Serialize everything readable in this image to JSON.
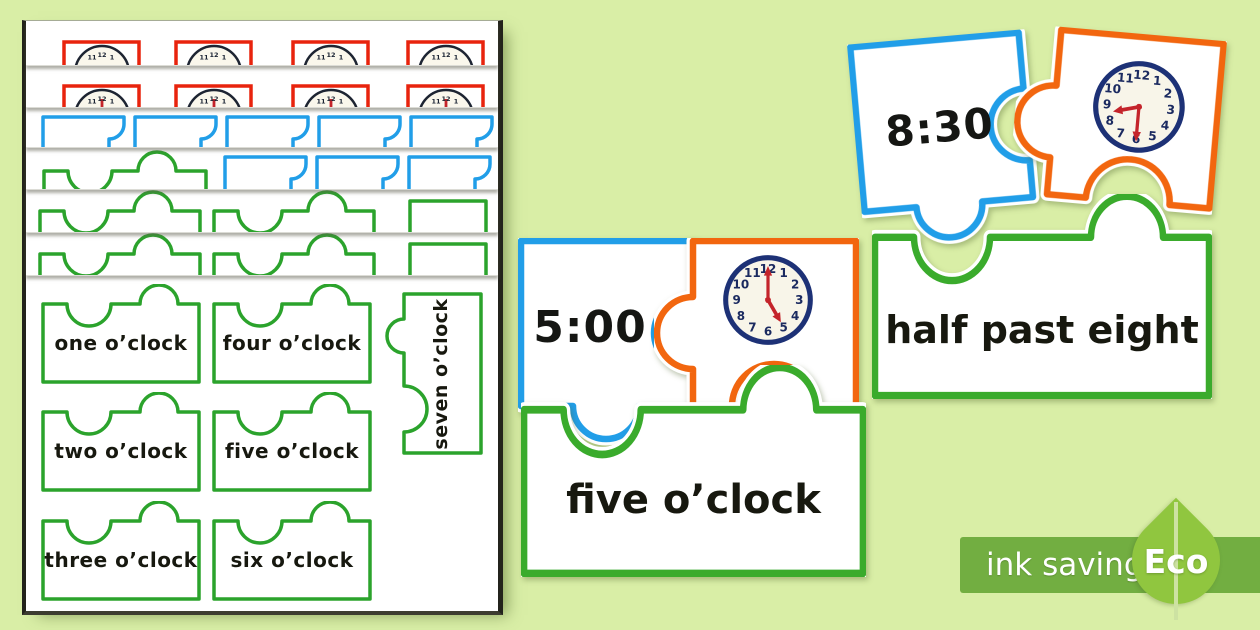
{
  "page_background": "#d9eea6",
  "stack": {
    "word_cards": [
      {
        "label": "one o’clock"
      },
      {
        "label": "four o’clock"
      },
      {
        "label": "seven o’clock"
      },
      {
        "label": "two o’clock"
      },
      {
        "label": "five o’clock"
      },
      {
        "label": "three o’clock"
      },
      {
        "label": "six o’clock"
      }
    ]
  },
  "clock_numbers": [
    "12",
    "1",
    "2",
    "3",
    "4",
    "5",
    "6",
    "7",
    "8",
    "9",
    "10",
    "11"
  ],
  "puzzles": [
    {
      "digital": "8:30",
      "words": "half past eight",
      "time_shown": "8:30"
    },
    {
      "digital": "5:00",
      "words": "five o’clock",
      "time_shown": "5:00"
    }
  ],
  "badge": {
    "ink_saving": "ink saving",
    "eco": "Eco"
  },
  "colors": {
    "red": "#e8230d",
    "blue": "#219ee8",
    "green": "#2ba32c",
    "orange": "#f2660f",
    "clock_ring": "#1d3176",
    "clock_hands": "#c4242b",
    "badge_bar": "#72ae41",
    "leaf": "#90c63f"
  }
}
